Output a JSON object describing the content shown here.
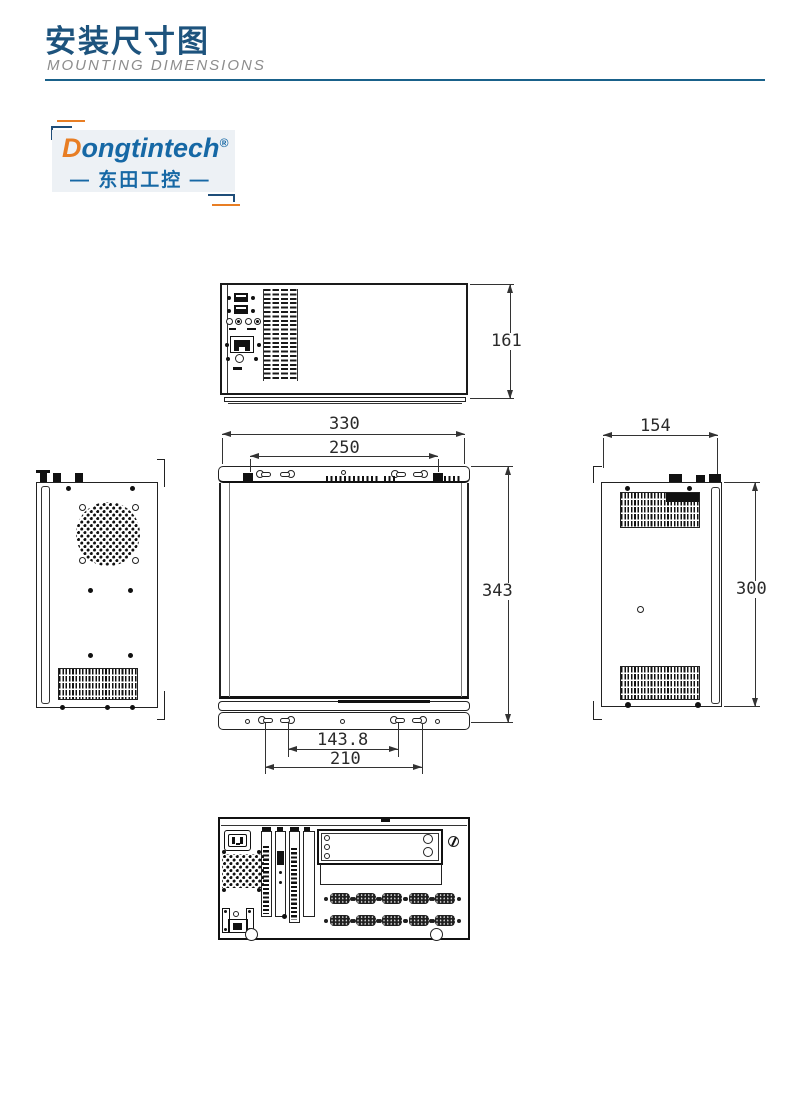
{
  "header": {
    "title": "安装尺寸图",
    "subtitle": "MOUNTING DIMENSIONS"
  },
  "logo": {
    "brand_initial": "D",
    "brand_rest": "ongtintech",
    "registered_mark": "®",
    "cn_left_dash": "—",
    "cn_name": "东田工控",
    "cn_right_dash": "—"
  },
  "drawing": {
    "front_view": {
      "height_mm": "161"
    },
    "top_view": {
      "overall_width_mm": "330",
      "top_mount_spacing_mm": "250",
      "overall_depth_mm": "343",
      "bottom_mount_inner_mm": "143.8",
      "bottom_mount_outer_mm": "210"
    },
    "right_side_view": {
      "width_mm": "154",
      "height_mm": "300"
    }
  },
  "colors": {
    "title_blue": "#1d537d",
    "rule_blue": "#19618a",
    "logo_blue": "#1668a5",
    "logo_orange": "#e87e24",
    "line_dark": "#1a1a1a"
  }
}
